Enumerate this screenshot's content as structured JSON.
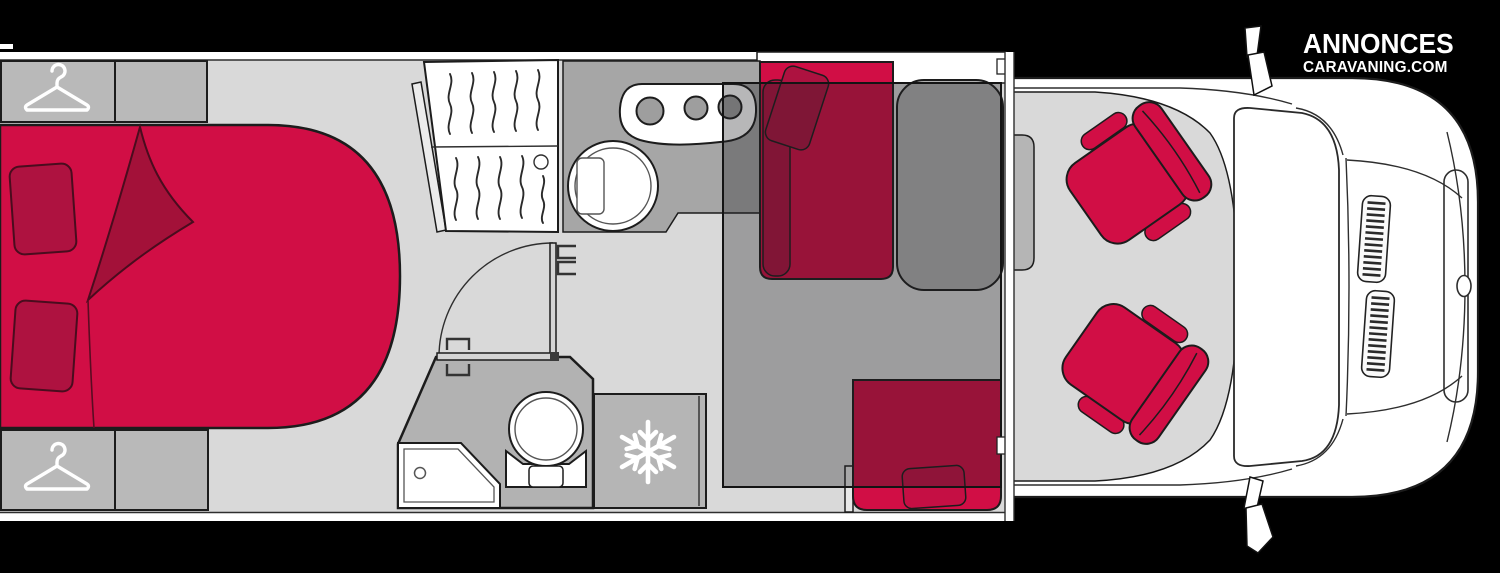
{
  "meta": {
    "type": "motorhome-floorplan-diagram",
    "view": "top-down"
  },
  "logo": {
    "line1": "ANNONCES",
    "line2": "CARAVANING.COM"
  },
  "palette": {
    "background": "#000000",
    "vehicle_body": "#ffffff",
    "floor": "#d9d9d9",
    "furniture_gray": "#b9b9b9",
    "counter_gray": "#a6a6a6",
    "bathroom_floor": "#b2b2b2",
    "table_gray": "#b0b0b0",
    "fridge_gray": "#b5b5b5",
    "accent_red": "#d10e45",
    "dark_red": "#a31139",
    "pillow_red": "#ae1240",
    "outline": "#1c1c1c",
    "icon_white": "#ffffff",
    "dropdown_bed_overlay": "rgba(30,30,35,0.32)"
  },
  "icons": [
    {
      "name": "hanger-icon",
      "represents": "wardrobe",
      "locations": [
        "rear-top-wardrobe",
        "rear-bottom-wardrobe"
      ]
    },
    {
      "name": "snowflake-icon",
      "represents": "refrigerator",
      "locations": [
        "refrigerator"
      ]
    }
  ],
  "areas": [
    "rear-bed",
    "bed-pillows",
    "folded-blanket",
    "rear-top-wardrobe",
    "rear-bottom-wardrobe",
    "slatted-cabinet",
    "kitchen-counter",
    "hob-three-burners",
    "kitchen-sink",
    "bathroom",
    "bathroom-door",
    "toilet",
    "shower-tray",
    "refrigerator",
    "dinette-bench-front",
    "dinette-bench-side",
    "dinette-table",
    "drop-down-bed-overlay",
    "dinette-window",
    "cab-floor",
    "driver-seat",
    "passenger-seat",
    "vehicle-front",
    "windshield",
    "hood-vents",
    "front-grille",
    "front-badge",
    "wing-mirror-top",
    "wing-mirror-bottom"
  ]
}
